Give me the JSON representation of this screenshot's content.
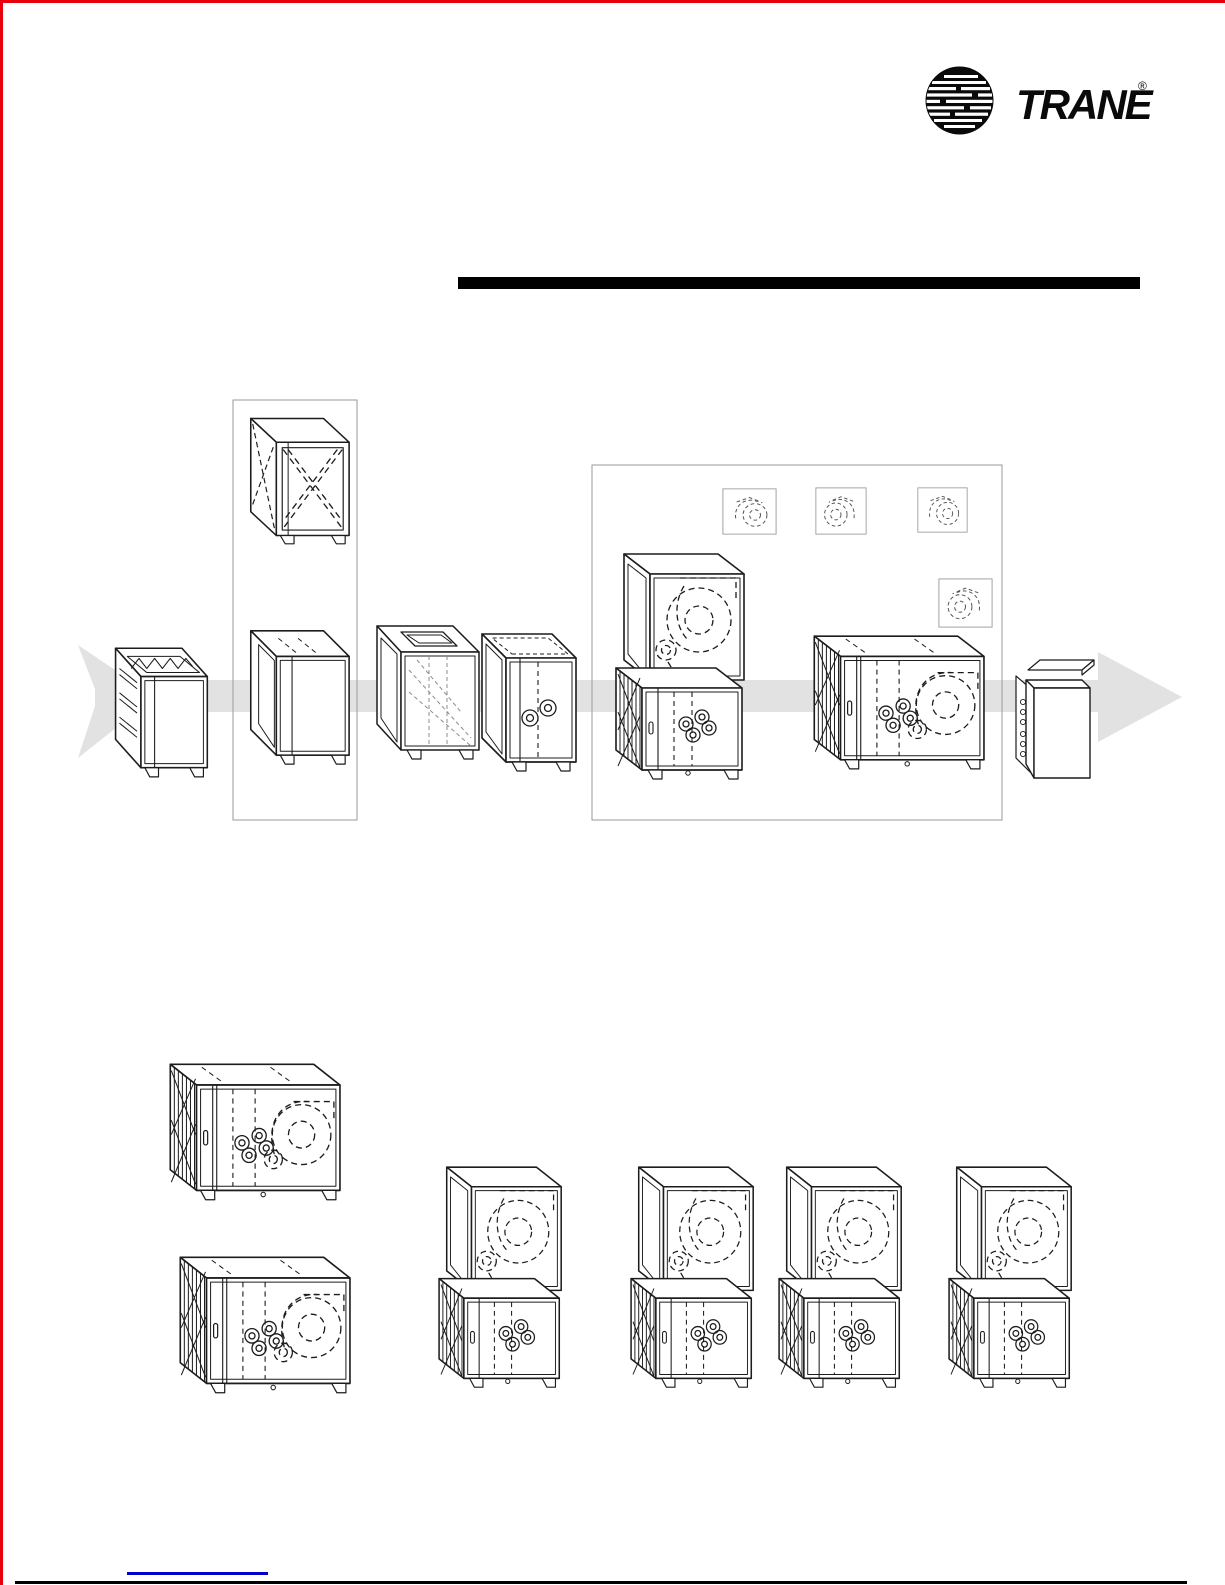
{
  "page": {
    "background": "#ffffff"
  },
  "brand": {
    "name": "TRANE",
    "registered": "®"
  },
  "colors": {
    "accent_red": "#e8000d",
    "ink": "#1c1c1c",
    "flow_band_gray": "#e2e2e2",
    "outline_gray": "#9a9a9a",
    "link_blue": "#0000cc",
    "bar_black": "#000000"
  },
  "icons": {
    "logo": "trane-globe-icon",
    "blower": "blower-scroll-icon",
    "flow_arrow": "flow-arrow-right-icon"
  }
}
